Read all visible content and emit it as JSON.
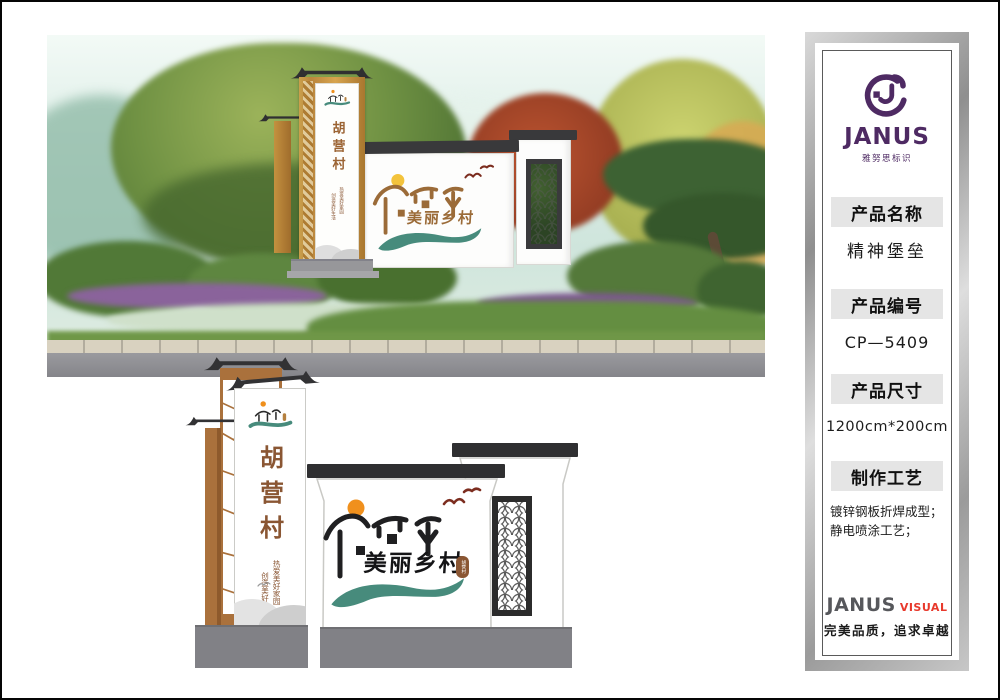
{
  "sign": {
    "village_name": "胡营村",
    "slogan_right": "创造美好生活",
    "slogan_left": "热爱美好家园",
    "wall_title": "美丽乡村",
    "seal_text": "胡营村"
  },
  "panel": {
    "logo_text": "JANUS",
    "logo_subtitle": "雅努思标识",
    "sections": [
      {
        "label": "产品名称",
        "value": "精神堡垒"
      },
      {
        "label": "产品编号",
        "value": "CP—5409"
      },
      {
        "label": "产品尺寸",
        "value": "1200cm*200cm"
      },
      {
        "label": "制作工艺",
        "value": "镀锌钢板折焊成型；静电喷涂工艺；"
      }
    ],
    "footer_brand": "JANUS",
    "footer_suffix": "VISUAL",
    "footer_tagline": "完美品质，追求卓越"
  },
  "colors": {
    "brand_purple": "#4e2a63",
    "accent_red": "#e8392c",
    "teal_river": "#478b7c",
    "wood_brown": "#aa713c",
    "sun_orange": "#f0901d",
    "roof_dark": "#323234",
    "base_gray": "#818186",
    "header_bg": "#e5e5e5"
  }
}
